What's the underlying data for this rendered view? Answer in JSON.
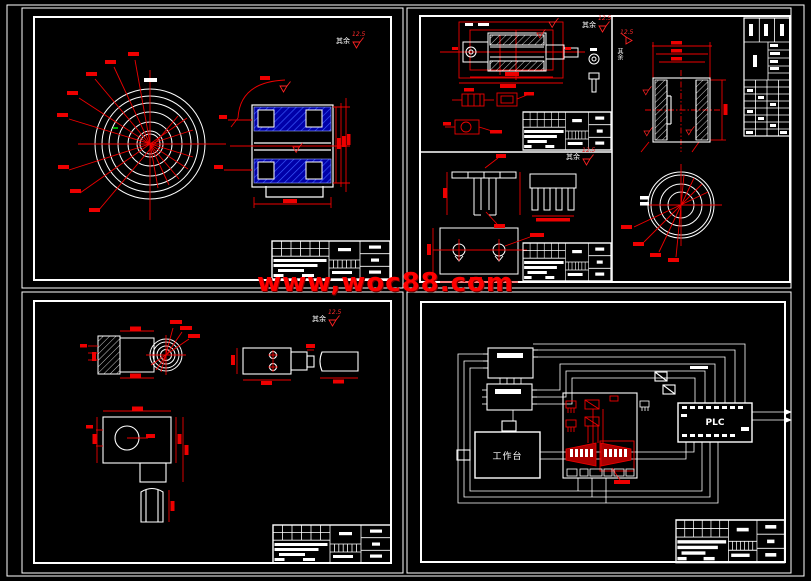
{
  "page": {
    "background": "#000000",
    "line_color": "#ffffff",
    "dimension_color": "#ff0000",
    "hatch_blue": "#0000a8"
  },
  "watermark": {
    "text": "www,woc88.com",
    "color": "#ff0000"
  },
  "sheets": {
    "top_left": {
      "surface_note": "其余",
      "roughness": "12.5"
    },
    "top_right_assembly": {
      "surface_note": "其余",
      "roughness": "12.5"
    },
    "top_right_fork": {
      "surface_note": "其余",
      "roughness": "12.5"
    },
    "top_right_bushing": {
      "surface_note": "其余",
      "roughness": "12.5"
    },
    "bottom_left": {
      "surface_note": "其余",
      "roughness": "12.5"
    },
    "bottom_right_schematic": {
      "plc_label": "PLC",
      "workbench_label": "工作台"
    }
  }
}
